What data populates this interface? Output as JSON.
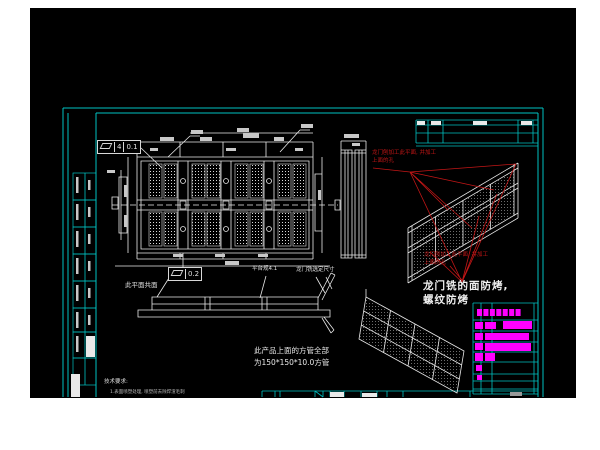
{
  "colors": {
    "page": "#ffffff",
    "canvas": "#000000",
    "frame": "#00c2c2",
    "line": "#e9e9e9",
    "dim_smudge": "#c8c8c8",
    "red": "#c21616",
    "magenta": "#ff00ff"
  },
  "annotations": {
    "fcf_top": {
      "datum": "4",
      "value": "0.1"
    },
    "fcf_mid": {
      "value": "0.2"
    },
    "coplanar_label": "此平面共面",
    "platform_label": "平台规4.1",
    "mill_label": "龙门铣选定尺寸",
    "red_note": {
      "line1": "龙门刨加工此平面, 并加工",
      "line2": "上面的孔"
    },
    "surface_note": {
      "line1": "龙门铣的面防烤,",
      "line2": "螺纹防烤"
    },
    "tube_note": {
      "line1": "此产品上面的方管全部",
      "line2": "为150*150*10.0方管"
    },
    "tech_notes": {
      "title": "技术要求:",
      "item1": "1.表面喷塑处理, 喷塑前去除焊渣毛刺"
    }
  },
  "plan_view": {
    "bays": [
      147,
      190,
      233,
      276
    ],
    "rows": [
      164,
      212
    ],
    "panel_w": 13,
    "panel_h": 34
  },
  "left_column": {
    "row_ys": [
      173,
      200,
      227,
      254,
      281,
      308,
      332,
      358,
      385
    ],
    "white_cells": [
      [
        86,
        336,
        9,
        21
      ],
      [
        71,
        374,
        9,
        23
      ]
    ]
  },
  "mini_table": {
    "x1": 416,
    "x2": 538,
    "h_ys": [
      120,
      125,
      133,
      143,
      146
    ],
    "v_xs": [
      416,
      428,
      443,
      518,
      533
    ],
    "white_cells": [
      [
        417,
        121,
        8,
        4
      ],
      [
        431,
        121,
        10,
        4
      ],
      [
        473,
        121,
        14,
        4
      ],
      [
        521,
        121,
        11,
        4
      ]
    ]
  },
  "magenta_table": {
    "x1": 473,
    "x2": 538,
    "v_xs": [
      473,
      481,
      492,
      534
    ],
    "h_ys": [
      303,
      320,
      331,
      342,
      352,
      362,
      374,
      381,
      389,
      394
    ],
    "header_bar": [
      477,
      309,
      45,
      7
    ],
    "marks": [
      [
        475,
        322,
        8,
        7
      ],
      [
        485,
        322,
        11,
        7
      ],
      [
        503,
        321,
        29,
        8
      ],
      [
        475,
        333,
        8,
        7
      ],
      [
        485,
        333,
        44,
        7
      ],
      [
        475,
        343,
        8,
        7
      ],
      [
        485,
        343,
        46,
        8
      ],
      [
        475,
        353,
        8,
        8
      ],
      [
        485,
        353,
        10,
        8
      ],
      [
        476,
        365,
        6,
        6
      ],
      [
        477,
        375,
        5,
        5
      ]
    ]
  },
  "bottom_strip": {
    "y": 391,
    "x1": 262,
    "x2": 538,
    "v_xs": [
      262,
      275,
      280,
      315,
      323,
      330,
      344,
      361,
      377,
      387,
      403,
      470
    ],
    "white_cells": [
      [
        330,
        392,
        14,
        5
      ],
      [
        362,
        393,
        15,
        4
      ]
    ],
    "gray_cell": [
      510,
      392,
      12,
      4
    ]
  },
  "dim_smudges": [
    [
      160,
      137,
      14,
      4
    ],
    [
      200,
      137,
      12,
      4
    ],
    [
      243,
      133,
      16,
      5
    ],
    [
      274,
      137,
      10,
      4
    ],
    [
      150,
      148,
      8,
      3
    ],
    [
      226,
      148,
      10,
      3
    ],
    [
      295,
      148,
      8,
      3
    ],
    [
      173,
      254,
      10,
      3
    ],
    [
      215,
      254,
      10,
      3
    ],
    [
      258,
      254,
      10,
      3
    ],
    [
      225,
      261,
      14,
      4
    ],
    [
      124,
      185,
      3,
      12
    ],
    [
      124,
      215,
      3,
      12
    ],
    [
      318,
      190,
      3,
      10
    ],
    [
      344,
      134,
      15,
      4
    ],
    [
      352,
      143,
      8,
      3
    ],
    [
      107,
      170,
      8,
      3
    ],
    [
      191,
      130,
      12,
      4
    ],
    [
      301,
      124,
      12,
      4
    ],
    [
      237,
      128,
      12,
      4
    ]
  ]
}
